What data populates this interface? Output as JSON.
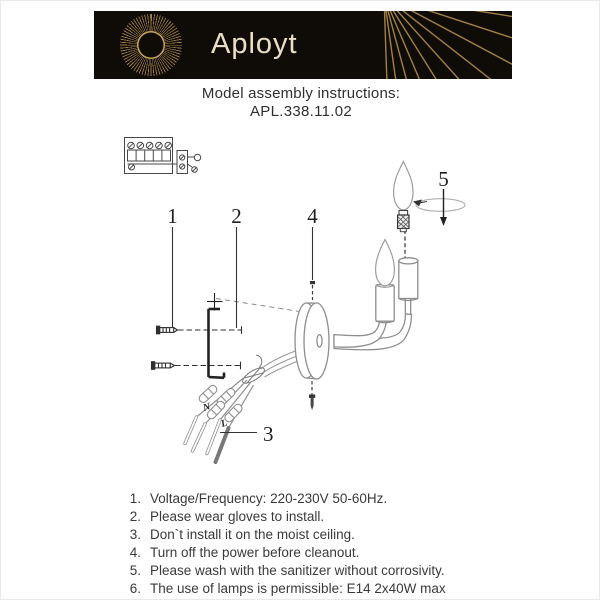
{
  "header": {
    "brand": "Aployt",
    "colors": {
      "banner_bg": "#0f0b07",
      "gold": "#a8884a",
      "brand_text": "#e9dfc6"
    }
  },
  "intro": {
    "title": "Model assembly instructions:",
    "model": "APL.338.11.02"
  },
  "diagram": {
    "callouts": {
      "c1": "1",
      "c2": "2",
      "c3": "3",
      "c4": "4",
      "c5": "5"
    },
    "wire_n": "N",
    "wire_l": "L"
  },
  "instructions": [
    {
      "num": "1.",
      "text": "Voltage/Frequency: 220-230V 50-60Hz."
    },
    {
      "num": "2.",
      "text": "Please wear gloves to install."
    },
    {
      "num": "3.",
      "text": "Don`t install it on the moist ceiling."
    },
    {
      "num": "4.",
      "text": "Turn off the power before cleanout."
    },
    {
      "num": "5.",
      "text": "Please wash with the sanitizer without corrosivity."
    },
    {
      "num": "6.",
      "text": "The use of lamps is permissible: E14 2x40W max"
    }
  ]
}
